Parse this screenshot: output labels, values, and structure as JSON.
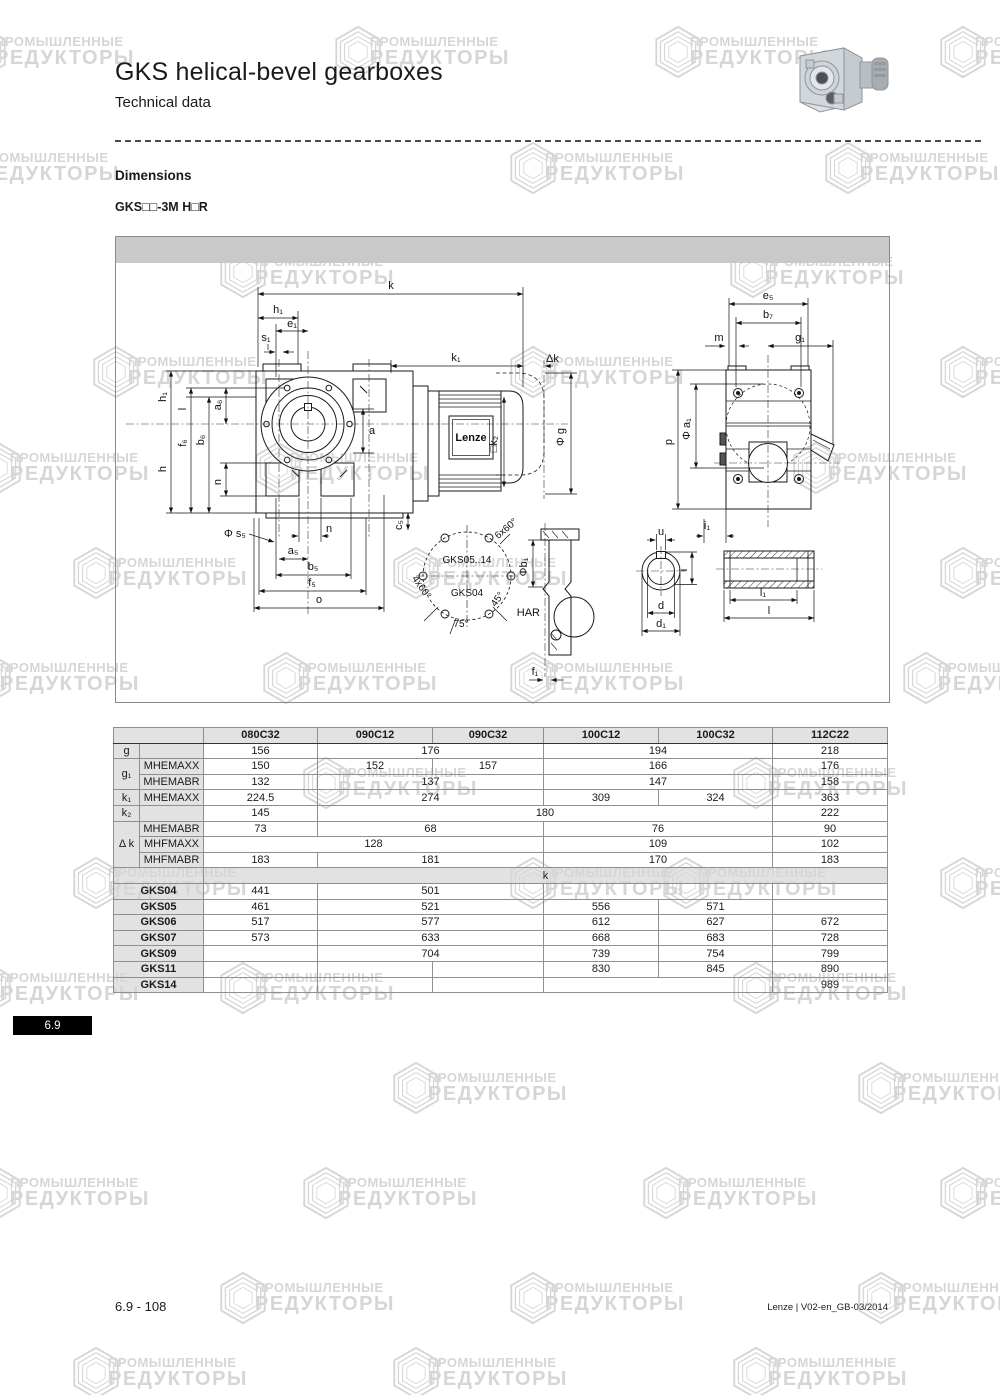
{
  "page": {
    "title": "GKS helical-bevel gearboxes",
    "subtitle": "Technical data",
    "section_heading": "Dimensions",
    "model_code": "GKS□□-3M H□R",
    "section_tab": "6.9",
    "footer_left": "6.9 - 108",
    "footer_right": "Lenze | V02-en_GB-03/2014"
  },
  "watermark": {
    "line1": "ПРОМЫШЛЕННЫЕ",
    "line2": "РЕДУКТОРЫ",
    "color": "#d6d6d6"
  },
  "drawing": {
    "brand": "Lenze",
    "labels": {
      "k": "k",
      "h1_top": "h₁",
      "e1": "e₁",
      "s1": "s₁",
      "k1": "k₁",
      "dk": "Δk",
      "h1_left": "h₁",
      "h": "h",
      "f6": "f₆",
      "b6": "b₆",
      "a6": "a₆",
      "l_left": "l",
      "n_left": "n",
      "a": "a",
      "c5": "c₅",
      "k2": "□k₂",
      "g_dia": "Φ g",
      "s5": "Φ s₅",
      "n_bottom": "n",
      "a5": "a₅",
      "b5": "b₅",
      "f5": "f₅",
      "o": "o",
      "e5": "e₅",
      "b7": "b₇",
      "m": "m",
      "g1": "g₁",
      "p": "p",
      "a1": "Φ a₁",
      "i1": "i₁",
      "gks0514": "GKS05..14",
      "gks04": "GKS04",
      "x660": "6x60°",
      "x460": "4x60°",
      "deg75": "75°",
      "deg45": "45°",
      "har": "HAR",
      "b1": "Φb₁",
      "f1": "f₁",
      "u": "u",
      "i": "i",
      "d": "d",
      "d1": "d₁",
      "l1": "l₁",
      "l": "l"
    }
  },
  "table": {
    "columns": [
      "080C32",
      "090C12",
      "090C32",
      "100C12",
      "100C32",
      "112C22"
    ],
    "section_label": "k",
    "rows": [
      {
        "l1": "g",
        "l1span": 1,
        "l2": "",
        "cells": [
          [
            "156",
            1
          ],
          [
            "176",
            2
          ],
          [
            "194",
            2
          ],
          [
            "218",
            1
          ]
        ]
      },
      {
        "l1": "g₁",
        "l1span": 2,
        "l2": "MHEMAXX",
        "cells": [
          [
            "150",
            1
          ],
          [
            "152",
            1
          ],
          [
            "157",
            1
          ],
          [
            "166",
            2
          ],
          [
            "176",
            1
          ]
        ]
      },
      {
        "l2": "MHEMABR",
        "cells": [
          [
            "132",
            1
          ],
          [
            "137",
            2
          ],
          [
            "147",
            2
          ],
          [
            "158",
            1
          ]
        ]
      },
      {
        "l1": "k₁",
        "l1span": 1,
        "l2": "MHEMAXX",
        "cells": [
          [
            "224.5",
            1
          ],
          [
            "274",
            2
          ],
          [
            "309",
            1
          ],
          [
            "324",
            1
          ],
          [
            "363",
            1
          ]
        ]
      },
      {
        "l1": "k₂",
        "l1span": 1,
        "l2": "",
        "cells": [
          [
            "145",
            1
          ],
          [
            "180",
            4
          ],
          [
            "222",
            1
          ]
        ]
      },
      {
        "l1": "Δ k",
        "l1span": 3,
        "l2": "MHEMABR",
        "cells": [
          [
            "73",
            1
          ],
          [
            "68",
            2
          ],
          [
            "76",
            2
          ],
          [
            "90",
            1
          ]
        ]
      },
      {
        "l2": "MHFMAXX",
        "cells": [
          [
            "128",
            3
          ],
          [
            "109",
            2
          ],
          [
            "102",
            1
          ]
        ]
      },
      {
        "l2": "MHFMABR",
        "cells": [
          [
            "183",
            1
          ],
          [
            "181",
            2
          ],
          [
            "170",
            2
          ],
          [
            "183",
            1
          ]
        ]
      },
      {
        "section": "k"
      },
      {
        "gks": "GKS04",
        "cells": [
          [
            "441",
            1
          ],
          [
            "501",
            2
          ],
          [
            "",
            2
          ],
          [
            "",
            1
          ]
        ]
      },
      {
        "gks": "GKS05",
        "cells": [
          [
            "461",
            1
          ],
          [
            "521",
            2
          ],
          [
            "556",
            1
          ],
          [
            "571",
            1
          ],
          [
            "",
            1
          ]
        ]
      },
      {
        "gks": "GKS06",
        "cells": [
          [
            "517",
            1
          ],
          [
            "577",
            2
          ],
          [
            "612",
            1
          ],
          [
            "627",
            1
          ],
          [
            "672",
            1
          ]
        ]
      },
      {
        "gks": "GKS07",
        "cells": [
          [
            "573",
            1
          ],
          [
            "633",
            2
          ],
          [
            "668",
            1
          ],
          [
            "683",
            1
          ],
          [
            "728",
            1
          ]
        ]
      },
      {
        "gks": "GKS09",
        "cells": [
          [
            "",
            1
          ],
          [
            "704",
            2
          ],
          [
            "739",
            1
          ],
          [
            "754",
            1
          ],
          [
            "799",
            1
          ]
        ]
      },
      {
        "gks": "GKS11",
        "cells": [
          [
            "",
            1
          ],
          [
            "",
            1
          ],
          [
            "",
            1
          ],
          [
            "830",
            1
          ],
          [
            "845",
            1
          ],
          [
            "890",
            1
          ]
        ]
      },
      {
        "gks": "GKS14",
        "cells": [
          [
            "",
            1
          ],
          [
            "",
            1
          ],
          [
            "",
            1
          ],
          [
            "",
            2
          ],
          [
            "989",
            1
          ]
        ]
      }
    ]
  }
}
